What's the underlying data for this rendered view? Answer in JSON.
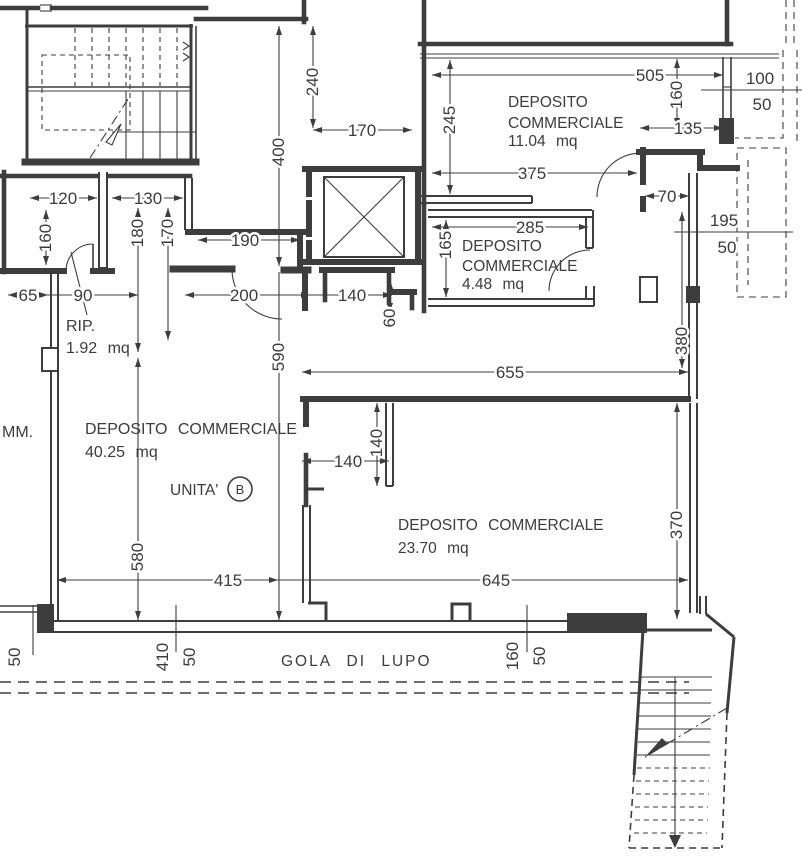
{
  "drawing": {
    "rooms": {
      "r11": {
        "line1": "DEPOSITO",
        "line2": "COMMERCIALE",
        "area": "11.04 mq"
      },
      "r448": {
        "line1": "DEPOSITO",
        "line2": "COMMERCIALE",
        "area": "4.48 mq"
      },
      "rip": {
        "name": "RIP.",
        "area": "1.92 mq"
      },
      "r4025": {
        "name": "DEPOSITO COMMERCIALE",
        "area": "40.25 mq"
      },
      "r2370": {
        "name": "DEPOSITO COMMERCIALE",
        "area": "23.70 mq"
      }
    },
    "unit": {
      "label": "UNITA'",
      "letter": "B"
    },
    "street_label": "GOLA DI LUPO",
    "edge_text": "MM.",
    "dims": {
      "v240": "240",
      "v400": "400",
      "v170_lift": "170",
      "v505": "505",
      "v245": "245",
      "v160_r11": "160",
      "v135": "135",
      "v375": "375",
      "v100": "100",
      "v50_r11": "50",
      "v70": "70",
      "v195": "195",
      "v50_balcony": "50",
      "v285": "285",
      "v165": "165",
      "v120": "120",
      "v130": "130",
      "v160_left": "160",
      "v180": "180",
      "v170_left": "170",
      "v190": "190",
      "v65": "65",
      "v90": "90",
      "v200": "200",
      "v140_hall": "140",
      "v60": "60",
      "v590": "590",
      "v655": "655",
      "v380": "380",
      "v140_stub_v": "140",
      "v140_stub_h": "140",
      "v370": "370",
      "v580": "580",
      "v415": "415",
      "v645": "645",
      "v50_bl": "50",
      "v410": "410",
      "v50_bl2": "50",
      "v160_bc": "160",
      "v50_bc": "50"
    },
    "line_colors": {
      "ink": "#3d3d3d",
      "paper": "#ffffff"
    }
  }
}
